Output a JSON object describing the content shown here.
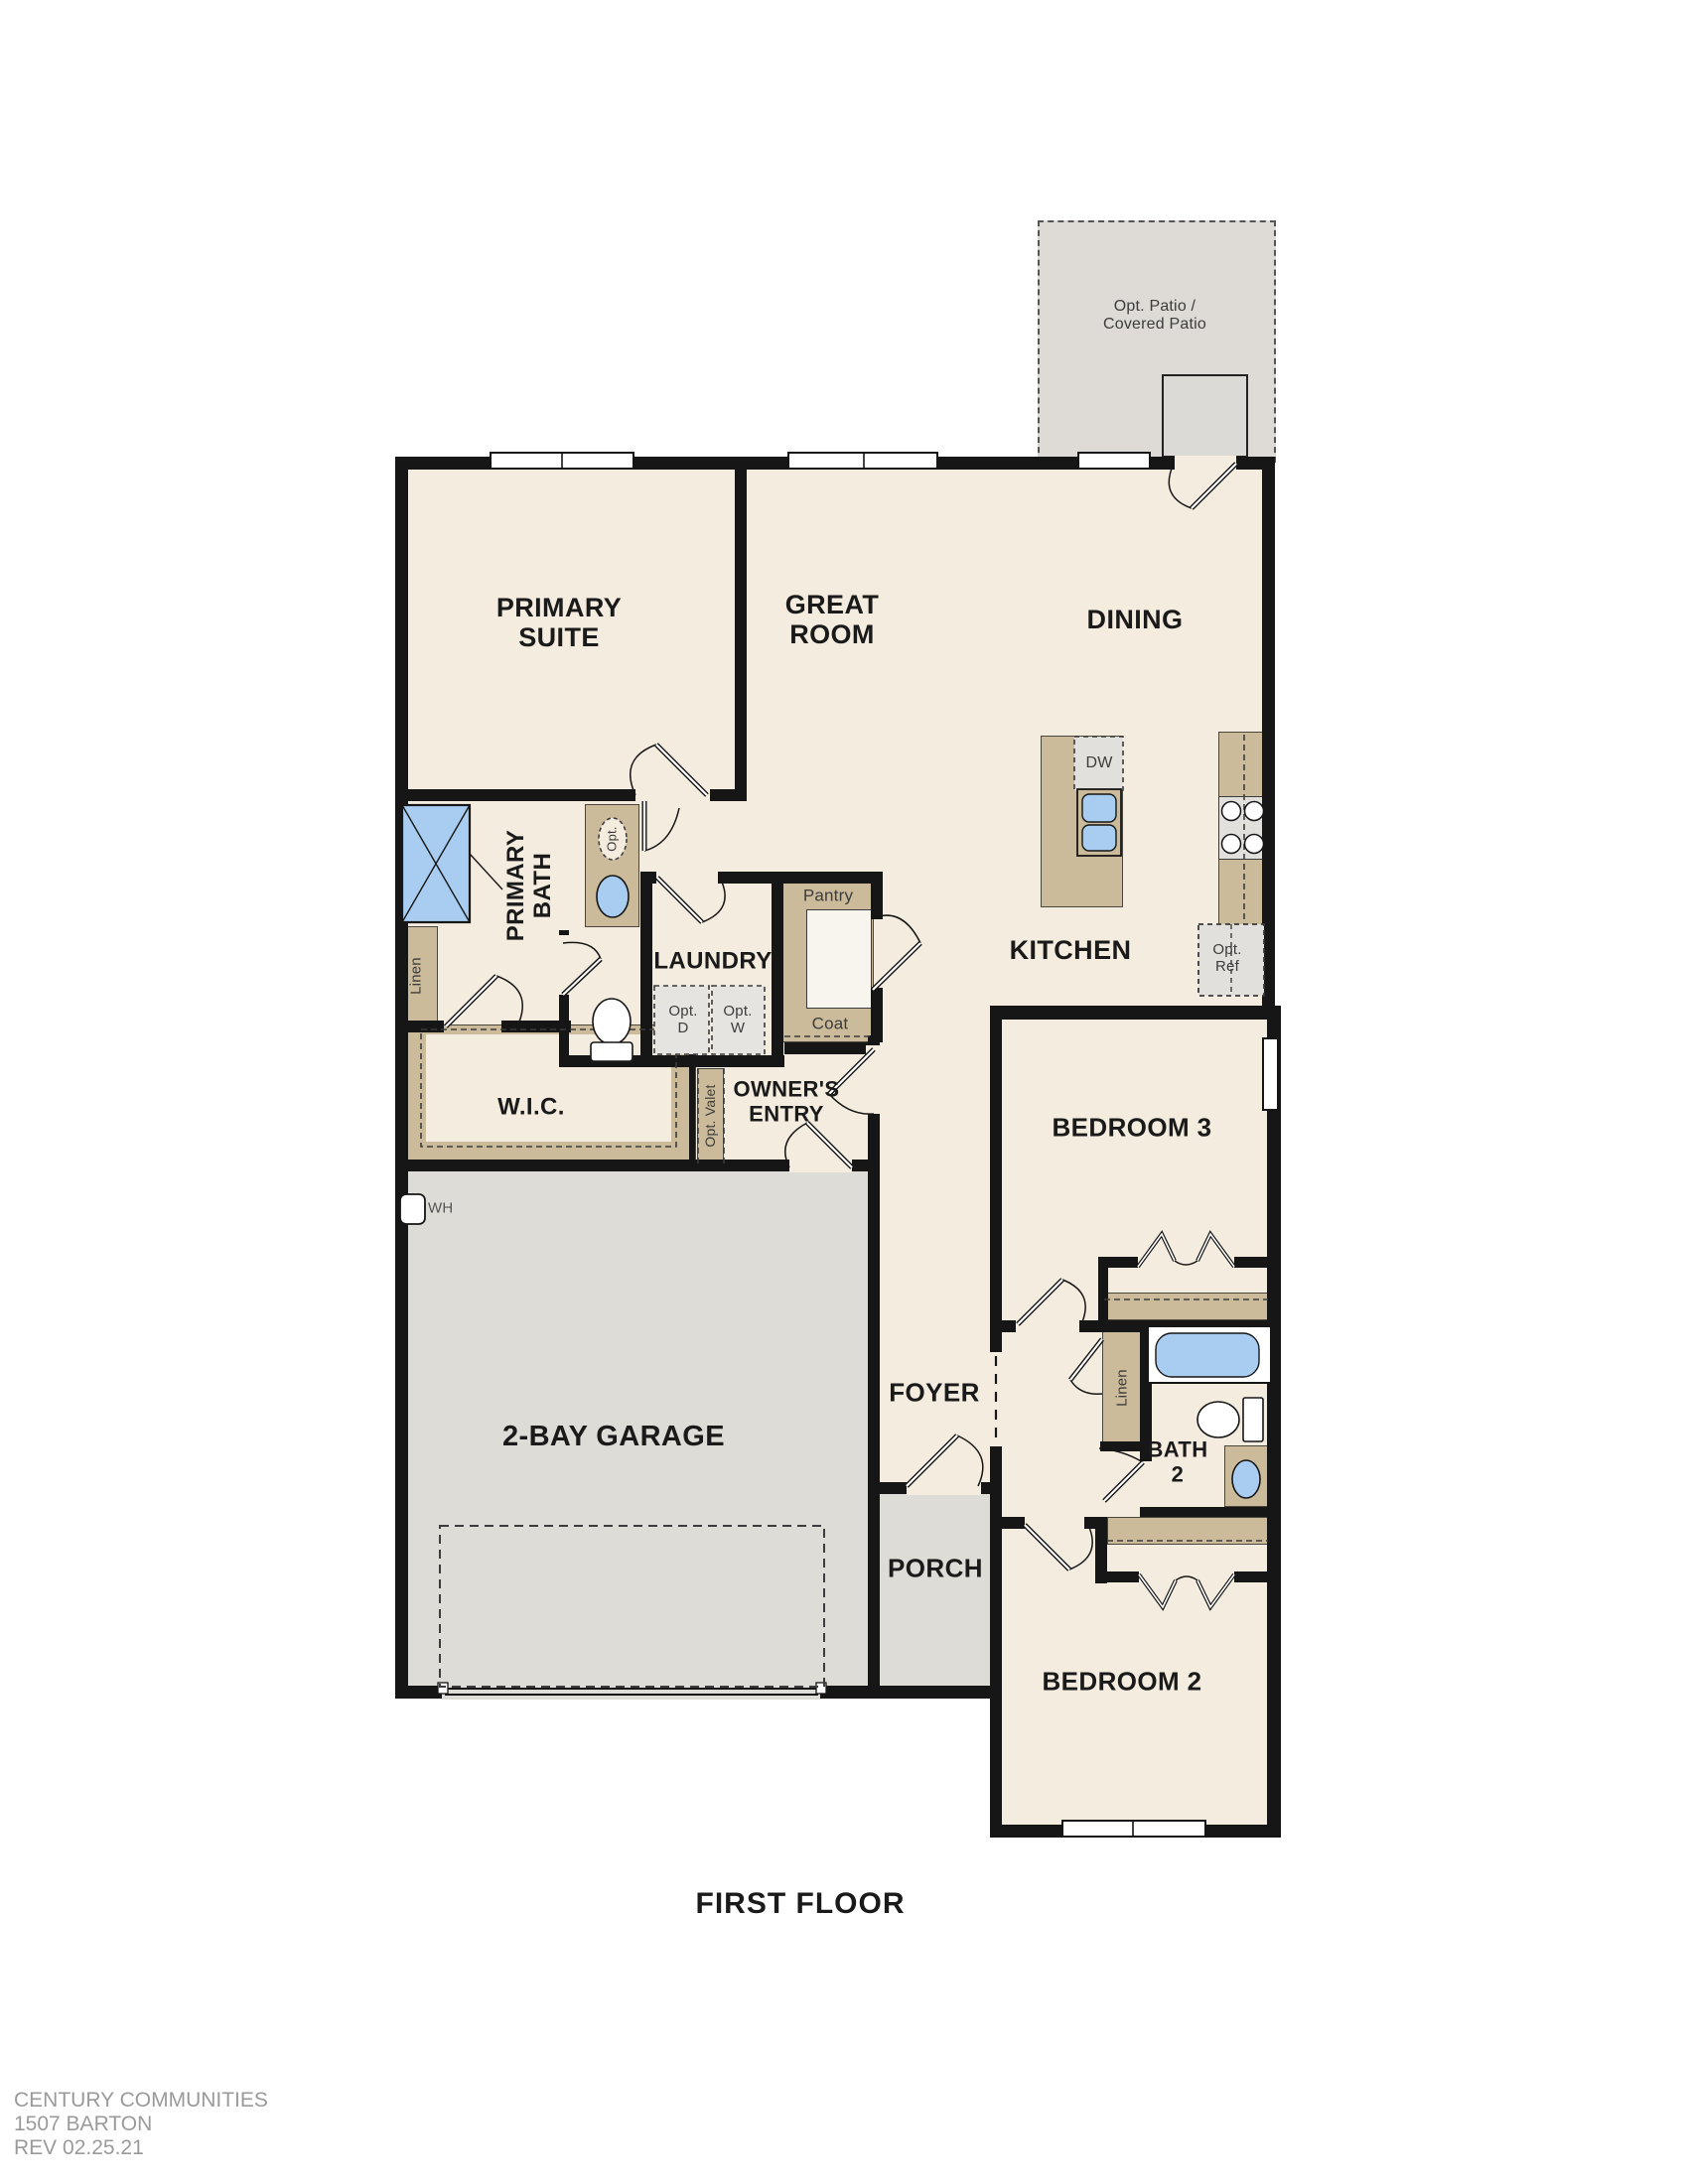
{
  "title": "FIRST FLOOR",
  "footer": {
    "company": "CENTURY COMMUNITIES",
    "plan": "1507 BARTON",
    "rev": "REV 02.25.21"
  },
  "rooms": {
    "patio": "Opt. Patio / Covered Patio",
    "primary_suite": "PRIMARY SUITE",
    "great_room": "GREAT ROOM",
    "dining": "DINING",
    "kitchen": "KITCHEN",
    "primary_bath": "PRIMARY BATH",
    "laundry": "LAUNDRY",
    "wic": "W.I.C.",
    "owners_entry": "OWNER'S ENTRY",
    "foyer": "FOYER",
    "porch": "PORCH",
    "garage": "2-BAY GARAGE",
    "bedroom3": "BEDROOM 3",
    "bath2": "BATH 2",
    "bedroom2": "BEDROOM 2"
  },
  "features": {
    "pantry": "Pantry",
    "coat": "Coat",
    "linen_primary": "Linen",
    "linen_bath2": "Linen",
    "dishwasher": "DW",
    "opt_dryer": "Opt. D",
    "opt_washer": "Opt. W",
    "opt_fridge": "Opt. Ref",
    "opt_valet": "Opt. Valet",
    "water_heater": "WH",
    "opt_fixture": "Opt."
  },
  "colors": {
    "floor": "#f4ecde",
    "concrete": "#dedcd7",
    "casework_tan": "#cbbb9b",
    "appliance_gray": "#e2e0dc",
    "fixture_blue": "#a8cdf0",
    "wall": "#161616",
    "footer_text": "#9a9a9a"
  }
}
